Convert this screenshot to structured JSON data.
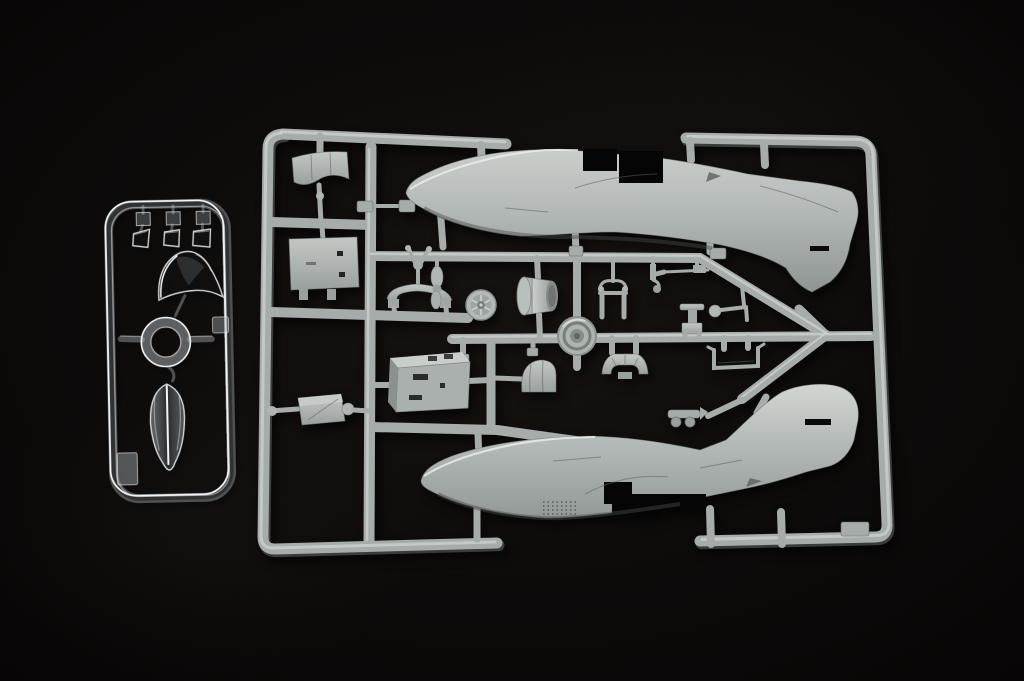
{
  "scene": {
    "description": "Photograph of two injection-moulded model aircraft kit sprues on a black background: a small clear sprue with canopy parts on the left and a large grey sprue with two fuselage halves and many small detail parts on the right",
    "items": [
      {
        "name": "clear-sprue",
        "label": "Clear parts sprue"
      },
      {
        "name": "grey-sprue",
        "label": "Grey parts sprue"
      }
    ]
  },
  "colors": {
    "background": "#0c0a09",
    "grey_plastic": "#a6aca9",
    "grey_plastic_light": "#d2d6d4",
    "grey_plastic_dark": "#7e8481",
    "grey_plastic_deep": "#646a67",
    "clear_edge": "#f2f6f8",
    "cutout_black": "#060505"
  },
  "clear_sprue": {
    "parts": [
      {
        "name": "windscreen-small-1"
      },
      {
        "name": "windscreen-small-2"
      },
      {
        "name": "windscreen-small-3"
      },
      {
        "name": "canopy-windscreen"
      },
      {
        "name": "sight-ring"
      },
      {
        "name": "teardrop-canopy"
      }
    ]
  },
  "grey_sprue": {
    "parts": [
      {
        "name": "fuselage-half-upper"
      },
      {
        "name": "fuselage-half-lower"
      },
      {
        "name": "cowl-panel"
      },
      {
        "name": "bulkhead-plate"
      },
      {
        "name": "gear-door-assembly"
      },
      {
        "name": "cockpit-tub"
      },
      {
        "name": "headrest-dome"
      },
      {
        "name": "tail-wheel-fork"
      },
      {
        "name": "cowling-arc"
      },
      {
        "name": "spoked-wheel"
      },
      {
        "name": "engine-cylinder"
      },
      {
        "name": "prop-lever"
      },
      {
        "name": "main-wheel"
      },
      {
        "name": "gear-fork"
      },
      {
        "name": "gun-lever"
      },
      {
        "name": "gun-barrel"
      },
      {
        "name": "exhaust-fan"
      },
      {
        "name": "bomb-trolley"
      },
      {
        "name": "seat"
      },
      {
        "name": "rod-bracket"
      },
      {
        "name": "u-bracket"
      }
    ]
  }
}
